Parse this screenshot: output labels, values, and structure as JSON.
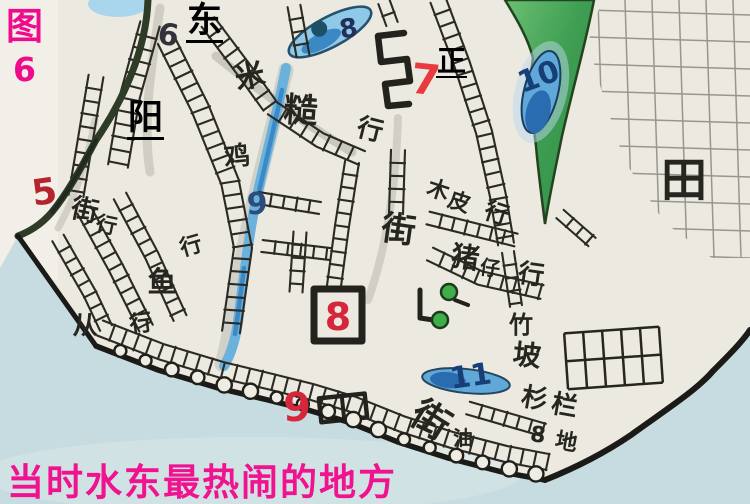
{
  "figure_label": {
    "char": "图",
    "number": "6"
  },
  "street_overlays": [
    {
      "id": "dong",
      "text": "东"
    },
    {
      "id": "yang",
      "text": "阳"
    },
    {
      "id": "zheng",
      "text": "正"
    }
  ],
  "caption": "当时水东最热闹的地方",
  "map_content": {
    "place_labels": [
      {
        "name": "mi-cao-hang",
        "chars": [
          {
            "t": "米",
            "x": 252,
            "y": 86,
            "s": 30,
            "r": -12
          },
          {
            "t": "糙",
            "x": 300,
            "y": 122,
            "s": 34,
            "r": 4
          },
          {
            "t": "行",
            "x": 368,
            "y": 138,
            "s": 26,
            "r": 14
          }
        ]
      },
      {
        "name": "ji",
        "chars": [
          {
            "t": "鸡",
            "x": 238,
            "y": 165,
            "s": 26,
            "r": -6
          }
        ]
      },
      {
        "name": "hang-mid-left",
        "chars": [
          {
            "t": "行",
            "x": 193,
            "y": 253,
            "s": 22,
            "r": -16
          }
        ]
      },
      {
        "name": "jie-hang-left",
        "chars": [
          {
            "t": "街",
            "x": 83,
            "y": 219,
            "s": 27,
            "r": 12
          },
          {
            "t": "行",
            "x": 105,
            "y": 232,
            "s": 21,
            "r": 12
          }
        ]
      },
      {
        "name": "yu-hang",
        "chars": [
          {
            "t": "鱼",
            "x": 162,
            "y": 292,
            "s": 29,
            "r": 0
          },
          {
            "t": "行",
            "x": 142,
            "y": 331,
            "s": 23,
            "r": -8
          }
        ]
      },
      {
        "name": "cong",
        "chars": [
          {
            "t": "从",
            "x": 85,
            "y": 334,
            "s": 25,
            "r": 0
          }
        ]
      },
      {
        "name": "jie-center",
        "chars": [
          {
            "t": "街",
            "x": 397,
            "y": 241,
            "s": 34,
            "r": 8
          }
        ]
      },
      {
        "name": "mu-pi-hang",
        "chars": [
          {
            "t": "木",
            "x": 436,
            "y": 197,
            "s": 22,
            "r": 18
          },
          {
            "t": "皮",
            "x": 457,
            "y": 209,
            "s": 22,
            "r": 18
          },
          {
            "t": "行",
            "x": 494,
            "y": 221,
            "s": 24,
            "r": 18
          }
        ]
      },
      {
        "name": "zhu-zai-hang",
        "chars": [
          {
            "t": "猪",
            "x": 464,
            "y": 267,
            "s": 28,
            "r": 8
          },
          {
            "t": "仔",
            "x": 489,
            "y": 275,
            "s": 20,
            "r": 8
          },
          {
            "t": "行",
            "x": 530,
            "y": 283,
            "s": 26,
            "r": 8
          }
        ]
      },
      {
        "name": "zhu-po",
        "chars": [
          {
            "t": "竹",
            "x": 521,
            "y": 333,
            "s": 24,
            "r": 0
          },
          {
            "t": "坡",
            "x": 526,
            "y": 365,
            "s": 28,
            "r": 6
          }
        ]
      },
      {
        "name": "shan-lan",
        "chars": [
          {
            "t": "杉",
            "x": 533,
            "y": 407,
            "s": 26,
            "r": 10
          },
          {
            "t": "栏",
            "x": 563,
            "y": 414,
            "s": 26,
            "r": 10
          }
        ]
      },
      {
        "name": "di",
        "chars": [
          {
            "t": "地",
            "x": 565,
            "y": 449,
            "s": 22,
            "r": 10
          }
        ]
      },
      {
        "name": "you",
        "chars": [
          {
            "t": "油",
            "x": 463,
            "y": 445,
            "s": 20,
            "r": 0
          }
        ]
      },
      {
        "name": "jie-bottom",
        "chars": [
          {
            "t": "街",
            "x": 424,
            "y": 431,
            "s": 38,
            "r": 32
          }
        ]
      },
      {
        "name": "tian",
        "chars": [
          {
            "t": "田",
            "x": 684,
            "y": 196,
            "s": 46,
            "r": 0,
            "w": 700
          }
        ]
      }
    ],
    "number_markers": [
      {
        "t": "5",
        "x": 46,
        "y": 204,
        "c": "#b5242c",
        "s": 36,
        "r": -8
      },
      {
        "t": "6",
        "x": 167,
        "y": 45,
        "c": "#33323a",
        "s": 30,
        "r": 8
      },
      {
        "t": "7",
        "x": 424,
        "y": 94,
        "c": "#e93a40",
        "s": 42,
        "r": 6
      },
      {
        "t": "8",
        "x": 350,
        "y": 37,
        "c": "#223058",
        "s": 26,
        "r": -10
      },
      {
        "t": "8",
        "x": 338,
        "y": 330,
        "c": "#d6263c",
        "s": 38,
        "r": 0
      },
      {
        "t": "9",
        "x": 257,
        "y": 214,
        "c": "#2a4e79",
        "s": 30,
        "r": 0
      },
      {
        "t": "9",
        "x": 297,
        "y": 421,
        "c": "#d6263c",
        "s": 40,
        "r": 0
      },
      {
        "t": "10",
        "x": 542,
        "y": 86,
        "c": "#173f77",
        "s": 30,
        "r": -20
      },
      {
        "t": "11",
        "x": 472,
        "y": 386,
        "c": "#173f77",
        "s": 30,
        "r": -8
      },
      {
        "t": "8",
        "x": 537,
        "y": 442,
        "c": "#26251f",
        "s": 22,
        "r": 8
      }
    ]
  },
  "palette": {
    "figure_label": "#f00a8c",
    "caption": "#f0128e",
    "overlay_text": "#000000",
    "ink": "#2b2a23",
    "red_marker": "#d6263c",
    "blue_ink": "#173f77",
    "water_blue": "#5fa8d8",
    "sea": "#c7dce0",
    "hill_green": "#3f9e52",
    "pencil_grid": "#8f8d86",
    "paper": "#ece9e0"
  }
}
